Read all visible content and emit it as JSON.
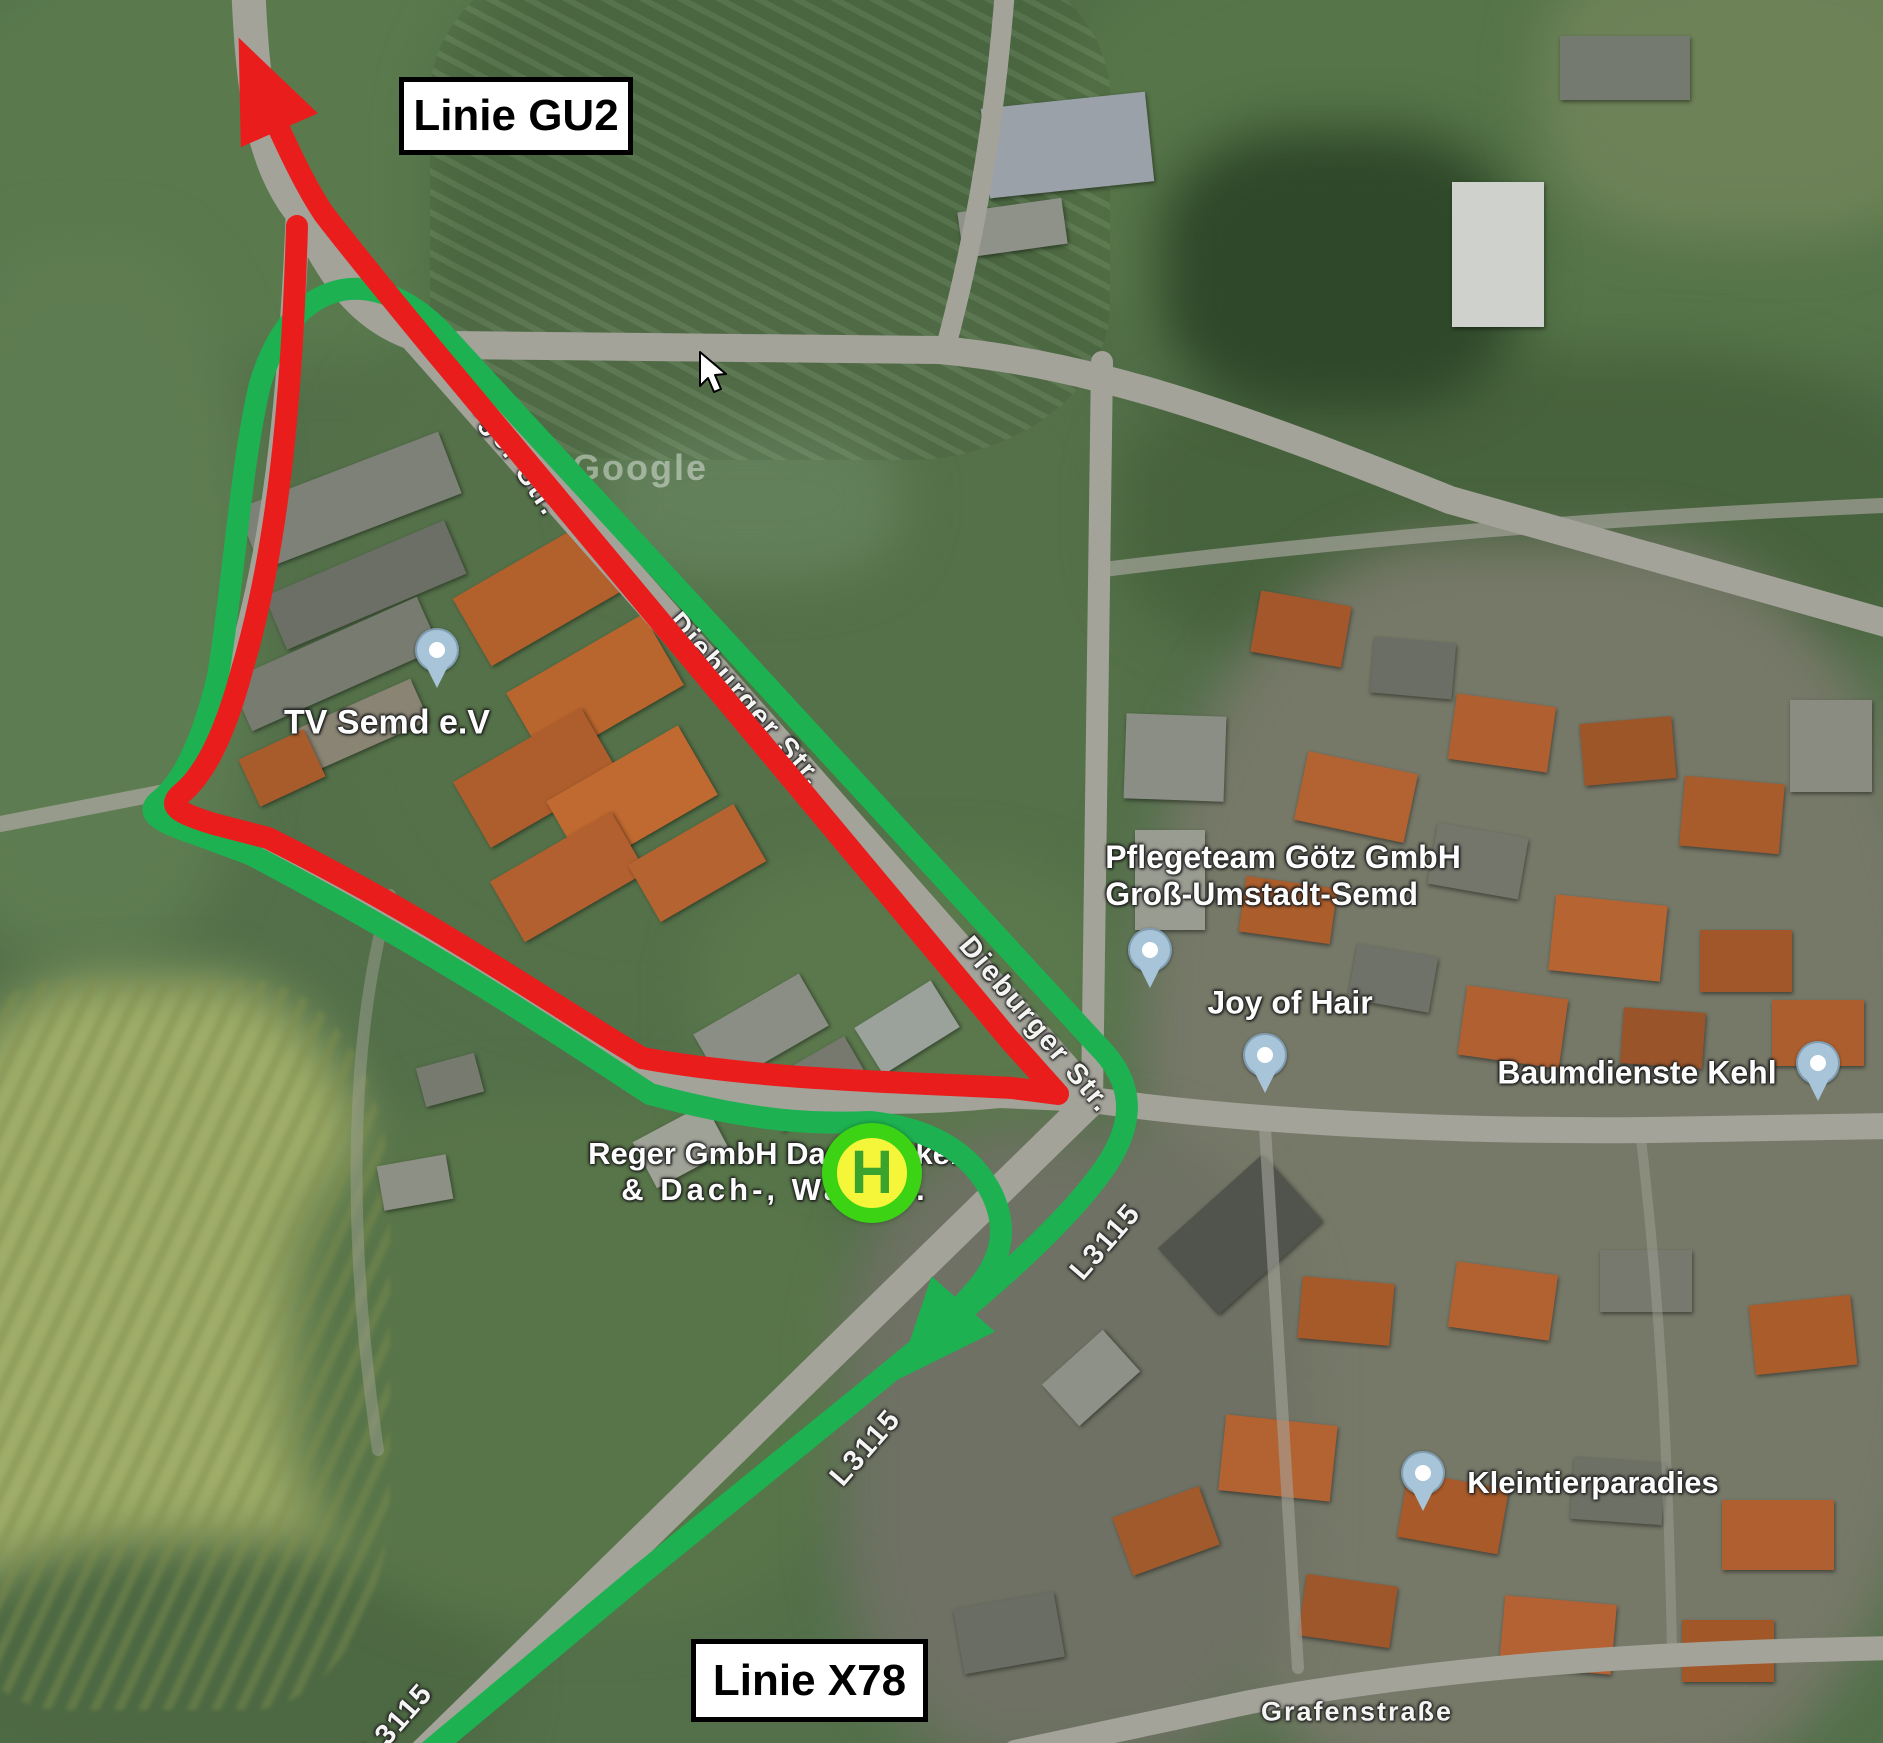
{
  "overlay": {
    "badges": [
      {
        "label": "Linie GU2"
      },
      {
        "label": "Linie X78"
      }
    ],
    "bus_stop": {
      "symbol": "H"
    },
    "colors": {
      "route_gu2_red": "#ea1d1d",
      "route_x78_green": "#1eb152",
      "stop_ring_green": "#3bd314",
      "stop_fill_yellow": "#f5f53a",
      "stop_letter_green": "#3aa32e"
    }
  },
  "map": {
    "watermark": "Google",
    "street_labels": [
      {
        "id": "dieburger-1",
        "text": "Dieburger Str."
      },
      {
        "id": "dieburger-2",
        "text": "Dieburger Str."
      },
      {
        "id": "dieburger-3",
        "text": "Dieburger Str."
      },
      {
        "id": "l3115-upper",
        "text": "L3115"
      },
      {
        "id": "l3115-mid",
        "text": "L3115"
      },
      {
        "id": "l3115-corner",
        "text": "L3115"
      },
      {
        "id": "grafenstrasse",
        "text": "Grafenstraße"
      }
    ],
    "places": [
      {
        "name": "TV Semd e.V"
      },
      {
        "name": "Pflegeteam Götz GmbH",
        "name2": "Groß-Umstadt-Semd"
      },
      {
        "name": "Joy of Hair"
      },
      {
        "name": "Baumdienste Kehl"
      },
      {
        "name": "Reger GmbH Dachdecker",
        "name2": "& Dach-, Wand..."
      },
      {
        "name": "Kleintierparadies"
      }
    ]
  }
}
